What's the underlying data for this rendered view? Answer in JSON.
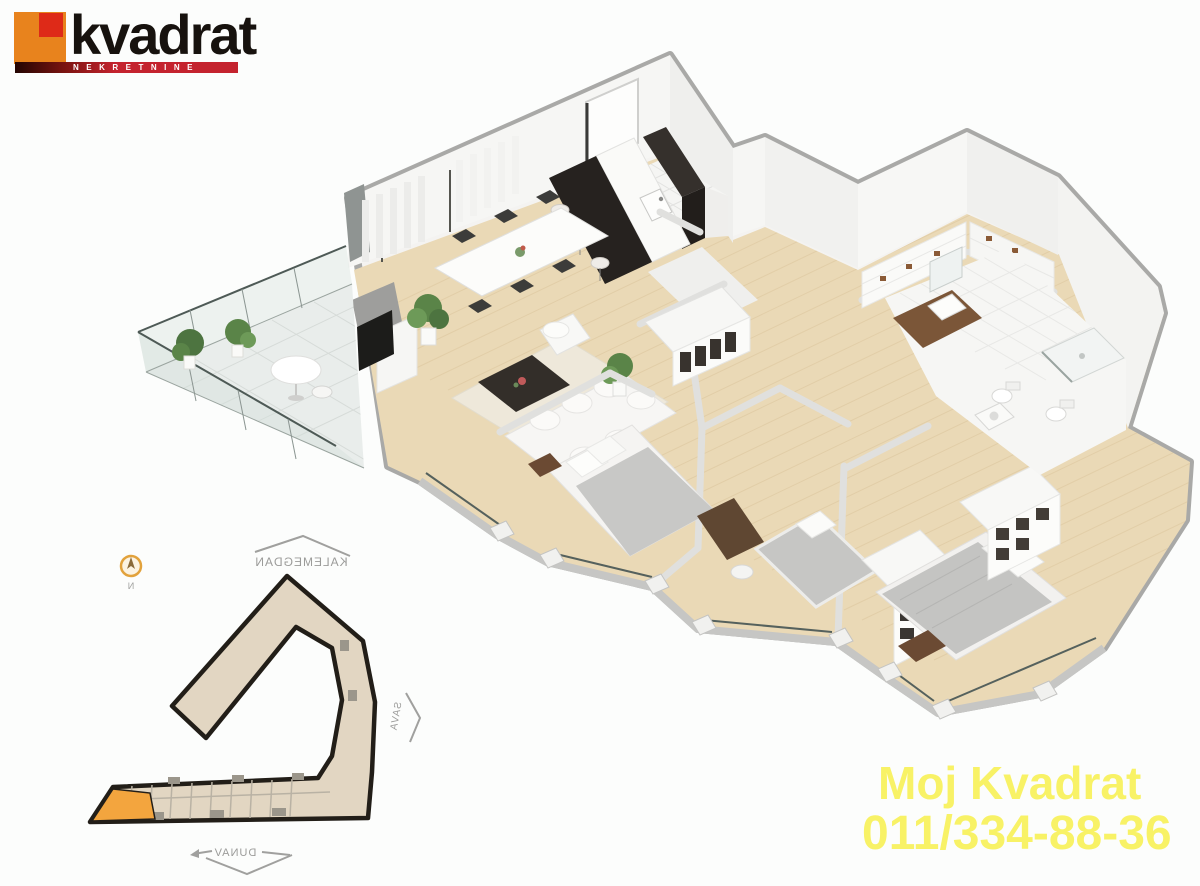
{
  "brand": {
    "name": "kvadrat",
    "tagline": "NEKRETNINE",
    "colors": {
      "square_orange": "#e8831d",
      "square_red": "#de2a18",
      "banner_red": "#c4232e",
      "banner_dark": "#230502",
      "wordmark": "#17120e"
    }
  },
  "contact": {
    "line1": "Moj Kvadrat",
    "phone": "011/334-88-36",
    "text_color": "#f8f266"
  },
  "site_map": {
    "label_top": "KALEMEGDAN",
    "label_right": "SAVA",
    "label_bottom": "DUNAV",
    "compass_letter": "N",
    "note": "labels appear mirrored in the render",
    "colors": {
      "building_fill": "#e2d6c2",
      "building_outline": "#221e18",
      "highlighted_unit": "#f3a53e",
      "compass_ring": "#e2a23c",
      "label_gray": "#9b9b99"
    }
  },
  "floor_plan": {
    "type": "3d-isometric-apartment-render",
    "colors": {
      "wall_top_gray": "#a9a9a7",
      "wall_face_white": "#f4f3f1",
      "wood_floor": "#ead9b6",
      "tile_floor": "#f5f5f3",
      "terrace_tile": "#e9edeb",
      "glass": "#dde7e2",
      "dark_furniture": "#2b2723",
      "wood_furniture": "#6b4a30",
      "bedding_gray": "#c6c6c4",
      "plant_green": "#5a8448"
    }
  }
}
